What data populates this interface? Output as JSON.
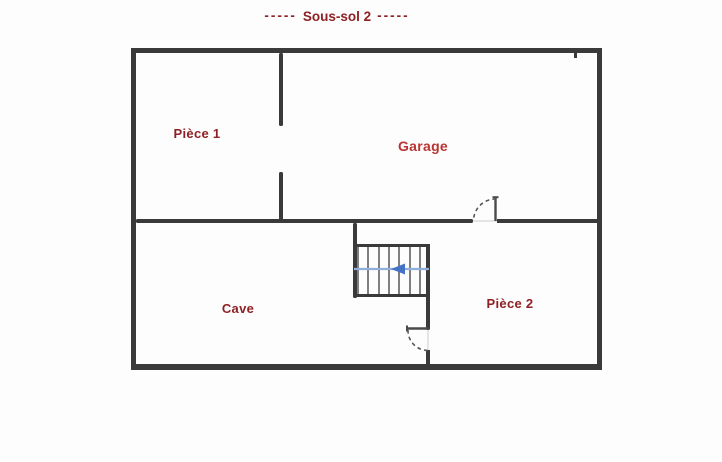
{
  "title": {
    "dashes_left": "-----",
    "text": "Sous-sol 2",
    "dashes_right": "-----"
  },
  "rooms": [
    {
      "name": "piece-1",
      "label": "Pièce 1"
    },
    {
      "name": "garage",
      "label": "Garage"
    },
    {
      "name": "cave",
      "label": "Cave"
    },
    {
      "name": "piece-2",
      "label": "Pièce 2"
    }
  ],
  "stairs": {
    "icon": "left-arrow-icon",
    "direction": "left",
    "visible_step_lines": 7
  },
  "doors": [
    {
      "name": "door-garage-piece2",
      "type": "swing-arc"
    },
    {
      "name": "door-stairs-piece2",
      "type": "swing-arc"
    }
  ],
  "colors": {
    "bg": "#fdfdfd",
    "label": "#8e2124",
    "garage": "#b93431",
    "wall": "#3a3a3a",
    "wall-thin": "#4a4a4a",
    "arrow-line": "#8fafdc",
    "arrow-head": "#4472c4"
  }
}
